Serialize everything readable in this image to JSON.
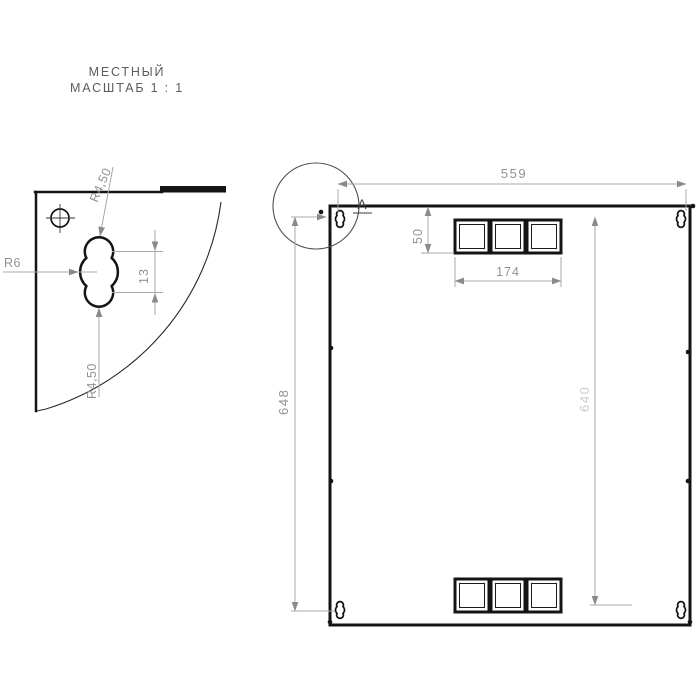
{
  "detail_view": {
    "title_line1": "МЕСТНЫЙ",
    "title_line2": "МАСШТАБ 1 : 1",
    "dim_radius_top": "R4,50",
    "dim_radius_left": "R6",
    "dim_center_distance": "13",
    "dim_radius_bottom": "R4,50"
  },
  "main_view": {
    "detail_label": "А",
    "dim_width_top": "559",
    "dim_height_left": "648",
    "dim_height_right": "640",
    "dim_slot_height_offset": "50",
    "dim_slot_group_width": "174"
  },
  "colors": {
    "background": "#ffffff",
    "outline": "#141414",
    "dimension": "#a9a9a9",
    "arrow": "#8a8a8a",
    "dim_text": "#929292",
    "dim_text_light": "#cbcbcb",
    "label": "#3a3a3a",
    "title": "#5c5c5c",
    "callout": "#4f4f4f"
  }
}
